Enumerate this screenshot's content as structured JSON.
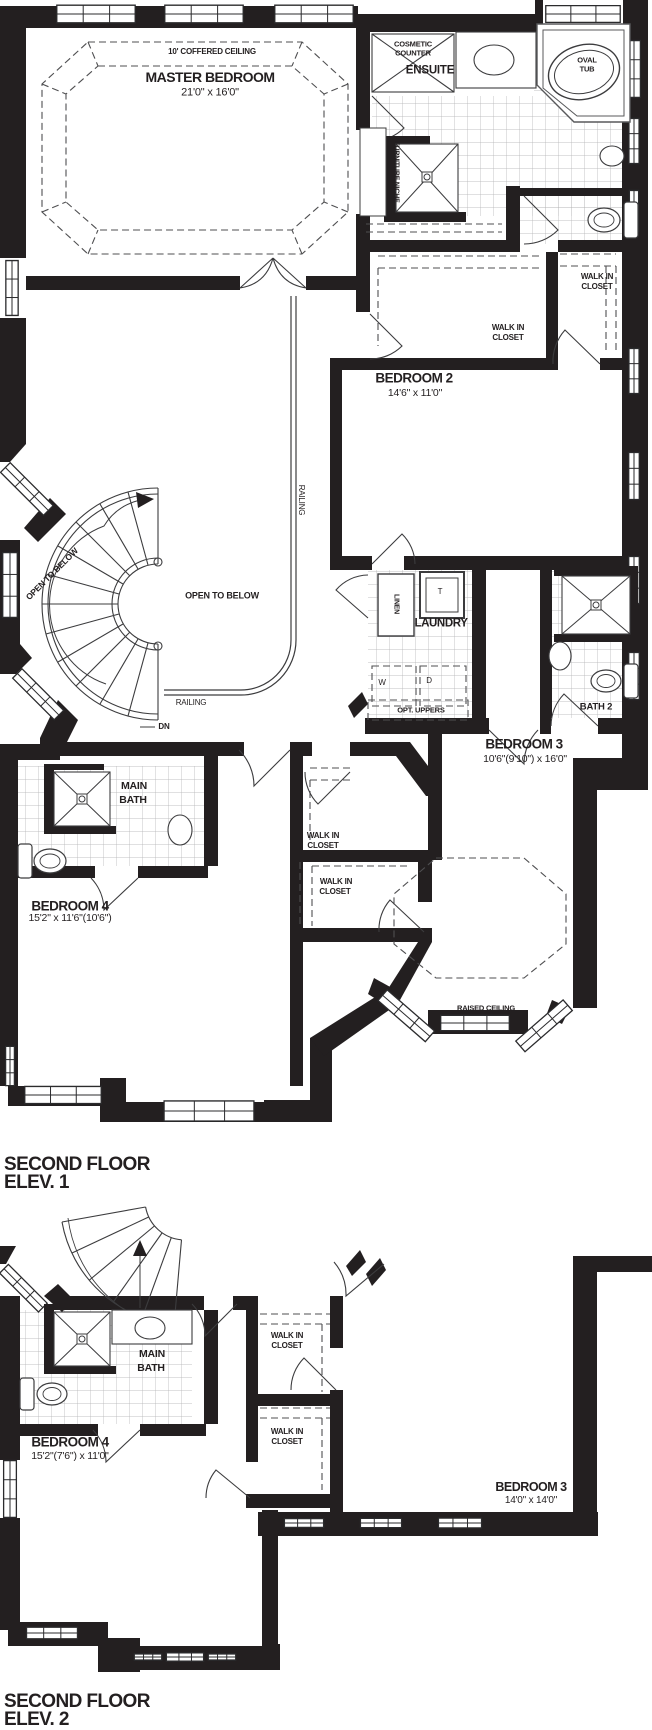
{
  "colors": {
    "ink": "#231f20",
    "line": "#4a4a4c",
    "tile": "#a8a8aa",
    "dash": "#4f4f51"
  },
  "shared": {
    "walk_in_closet_line1": "WALK IN",
    "walk_in_closet_line2": "CLOSET",
    "open_to_below": "OPEN TO BELOW",
    "railing": "RAILING",
    "down_label": "DN"
  },
  "plan1": {
    "title_line1": "SECOND FLOOR",
    "title_line2": "ELEV. 1",
    "master_bedroom": {
      "name": "MASTER BEDROOM",
      "dims": "21'0\" x 16'0\"",
      "ceiling": "10' COFFERED CEILING"
    },
    "ensuite": {
      "name": "ENSUITE",
      "cosmetic_line1": "COSMETIC",
      "cosmetic_line2": "COUNTER",
      "tub_line1": "OVAL",
      "tub_line2": "TUB",
      "niche": "FURNITURE NICHE"
    },
    "bedroom2": {
      "name": "BEDROOM 2",
      "dims": "14'6\" x 11'0\""
    },
    "bedroom3": {
      "name": "BEDROOM 3",
      "dims": "10'6\"(9'10\") x 16'0\"",
      "ceiling": "RAISED CEILING"
    },
    "bedroom4": {
      "name": "BEDROOM 4",
      "dims": "15'2\" x 11'6\"(10'6\")"
    },
    "bath2": {
      "name": "BATH 2"
    },
    "main_bath": {
      "line1": "MAIN",
      "line2": "BATH"
    },
    "laundry": {
      "name": "LAUNDRY",
      "linen": "LINEN",
      "tub": "T",
      "washer": "W",
      "dryer": "D",
      "uppers": "OPT. UPPERS"
    }
  },
  "plan2": {
    "title_line1": "SECOND FLOOR",
    "title_line2": "ELEV. 2",
    "main_bath": {
      "line1": "MAIN",
      "line2": "BATH"
    },
    "bedroom4": {
      "name": "BEDROOM 4",
      "dims": "15'2\"(7'6\") x 11'0\""
    },
    "bedroom3": {
      "name": "BEDROOM 3",
      "dims": "14'0\" x 14'0\""
    }
  }
}
